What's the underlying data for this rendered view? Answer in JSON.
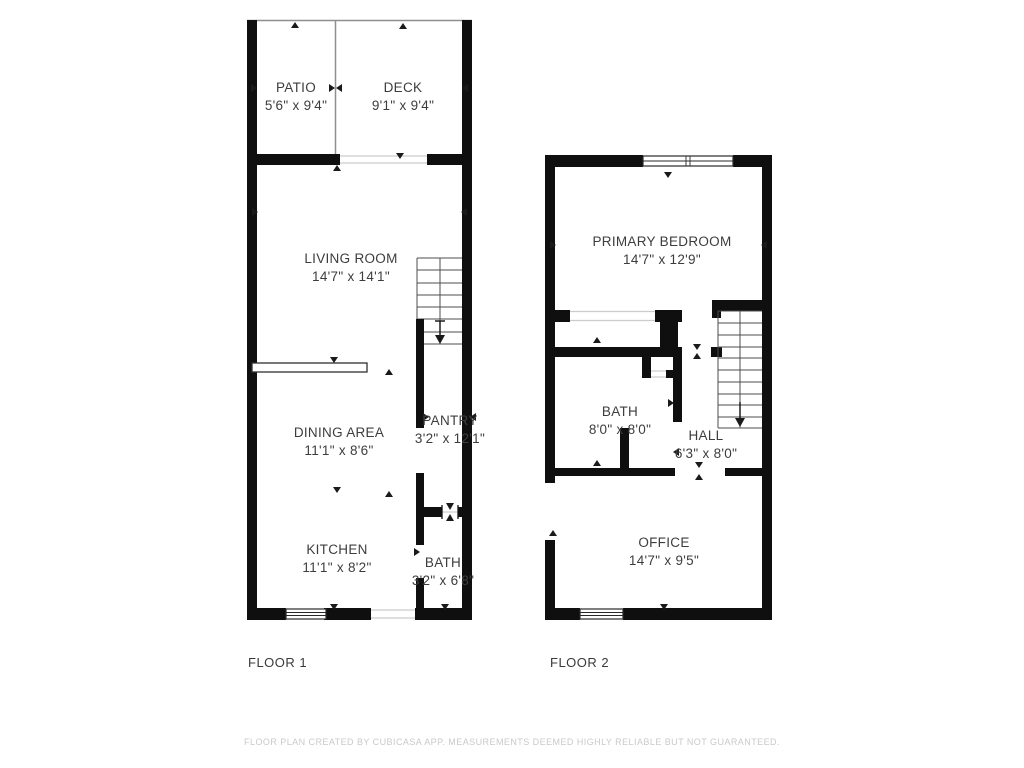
{
  "floor1": {
    "label": "FLOOR 1",
    "rooms": [
      {
        "name": "PATIO",
        "dims": "5'6\" x 9'4\""
      },
      {
        "name": "DECK",
        "dims": "9'1\" x 9'4\""
      },
      {
        "name": "LIVING ROOM",
        "dims": "14'7\" x 14'1\""
      },
      {
        "name": "DINING AREA",
        "dims": "11'1\" x 8'6\""
      },
      {
        "name": "PANTRY",
        "dims": "3'2\" x 12'1\""
      },
      {
        "name": "KITCHEN",
        "dims": "11'1\" x 8'2\""
      },
      {
        "name": "BATH",
        "dims": "3'2\" x 6'8\""
      }
    ]
  },
  "floor2": {
    "label": "FLOOR 2",
    "rooms": [
      {
        "name": "PRIMARY BEDROOM",
        "dims": "14'7\" x 12'9\""
      },
      {
        "name": "BATH",
        "dims": "8'0\" x 8'0\""
      },
      {
        "name": "HALL",
        "dims": "6'3\" x 8'0\""
      },
      {
        "name": "OFFICE",
        "dims": "14'7\" x 9'5\""
      }
    ]
  },
  "footer": {
    "disclaimer": "FLOOR PLAN CREATED BY CUBICASA APP. MEASUREMENTS DEEMED HIGHLY RELIABLE BUT NOT GUARANTEED."
  },
  "colors": {
    "wall": "#0f0f0f",
    "room_text": "#3d3d3d",
    "disclaimer": "#c9c9c9"
  }
}
